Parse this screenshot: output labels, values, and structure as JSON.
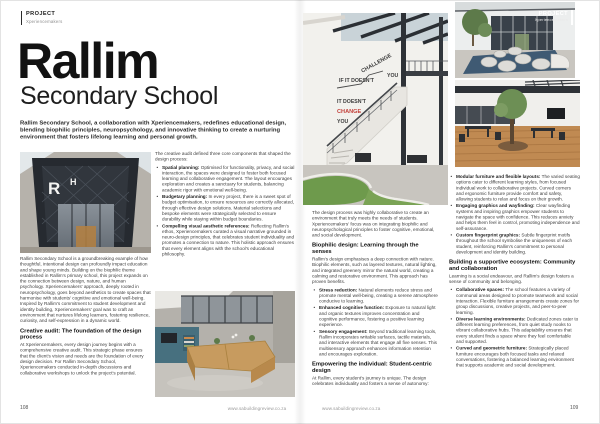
{
  "kicker": {
    "label": "PROJECT",
    "sublabel": "Xperiencemakers"
  },
  "title": {
    "main": "Rallim",
    "sub": "Secondary School"
  },
  "intro": "Rallim Secondary School, a collaboration with Xperiencemakers, redefines educational design, blending biophilic principles, neuropsychology, and innovative thinking to create a nurturing environment that fosters lifelong learning and personal growth.",
  "footer": {
    "url_left": "www.sabuildingreview.co.za",
    "url_right": "www.sabuildingreview.co.za",
    "page_left": "108",
    "page_right": "109"
  },
  "columns": {
    "col1": {
      "para1": "Rallim Secondary School is a groundbreaking example of how thoughtful, intentional design can profoundly impact education and shape young minds. Building on the biophilic theme established in Rallim's primary school, this project expands on the connection between design, nature, and human psychology. Xperiencemakers' approach, deeply rooted in neuropsychology, goes beyond aesthetics to create spaces that harmonise with students' cognitive and emotional well-being. Inspired by Rallim's commitment to student development and identity building, Xperiencemakers' goal was to craft an environment that nurtures lifelong learners, fostering resilience, curiosity, and self-expression in a dynamic world.",
      "heading": "Creative audit: The foundation of the design process",
      "para2": "At Xperiencemakers, every design journey begins with a comprehensive creative audit. This strategic phase ensures that the client's vision and needs are the foundation of every design decision. For Rallim Secondary School, Xperiencemakers conducted in-depth discussions and collaborative workshops to unlock the project's potential."
    },
    "col2": {
      "lead": "The creative audit defined three core components that shaped the design process:",
      "bullets": [
        {
          "term": "Spatial planning:",
          "text": "Optimised for functionality, privacy, and social interaction, the spaces were designed to foster both focused learning and collaborative engagement. The layout encourages exploration and creates a sanctuary for students, balancing academic rigor with emotional well-being."
        },
        {
          "term": "Budgetary planning:",
          "text": "In every project, there is a sweet spot of budget optimisation, to ensure resources are correctly allocated, through effective design solutions. Material selections and bespoke elements were strategically selected to ensure durability while staying within budget boundaries."
        },
        {
          "term": "Compelling visual aesthetic references:",
          "text": "Reflecting Rallim's ethos, Xperiencemakers curated a visual narrative grounded in neuro-design principles, that celebrates student individuality and promotes a connection to nature. This holistic approach ensures that every element aligns with the school's educational philosophy."
        }
      ]
    },
    "col3": {
      "para1": "The design process was highly collaborative to create an environment that truly meets the needs of students. Xperiencemakers' focus was on integrating biophilic and neuropsychological principles to foster cognitive, emotional, and social development.",
      "heading1": "Biophilic design: Learning through the senses",
      "para2": "Rallim's design emphasises a deep connection with nature. Biophilic elements, such as layered textures, natural lighting, and integrated greenery mirror the natural world, creating a calming and restorative environment. This approach has proven benefits.",
      "bullets": [
        {
          "term": "Stress reduction:",
          "text": "Natural elements reduce stress and promote mental well-being, creating a serene atmosphere conducive to learning."
        },
        {
          "term": "Enhanced cognitive function:",
          "text": "Exposure to natural light and organic textures improves concentration and cognitive performance, fostering a positive learning experience."
        },
        {
          "term": "Sensory engagement:",
          "text": "Beyond traditional learning tools, Rallim incorporates writable surfaces, tactile materials, and interactive elements that engage all five senses. This multisensory approach enhances information retention and encourages exploration."
        }
      ],
      "heading2": "Empowering the individual: Student-centric design",
      "para3": "At Rallim, every student's journey is unique. The design celebrates individuality and fosters a sense of autonomy:"
    },
    "col4": {
      "bullets1": [
        {
          "term": "Modular furniture and flexible layouts:",
          "text": "The varied seating options cater to different learning styles, from focused individual work to collaborative projects. Curved corners and ergonomic furniture provide comfort and safety, allowing students to relax and focus on their growth."
        },
        {
          "term": "Engaging graphics and wayfinding:",
          "text": "Clear wayfinding systems and inspiring graphics empower students to navigate the space with confidence. This reduces anxiety and helps them feel in control, promoting independence and self-assurance."
        },
        {
          "term": "Custom fingerprint graphics:",
          "text": "Subtle fingerprint motifs throughout the school symbolise the uniqueness of each student, reinforcing Rallim's commitment to personal development and identity building."
        }
      ],
      "heading": "Building a supportive ecosystem: Community and collaboration",
      "para": "Learning is a social endeavour, and Rallim's design fosters a sense of community and belonging.",
      "bullets2": [
        {
          "term": "Collaborative spaces:",
          "text": "The school features a variety of communal areas designed to promote teamwork and social interaction. Flexible furniture arrangements create zones for group discussions, creative projects, and peer-to-peer learning."
        },
        {
          "term": "Diverse learning environments:",
          "text": "Dedicated zones cater to different learning preferences, from quiet study nooks to vibrant collaborative hubs. This adaptability ensures that every student finds a space where they feel comfortable and supported."
        },
        {
          "term": "Curved and geometric furniture:",
          "text": "Strategically placed furniture encourages both focused tasks and relaxed conversations, fostering a balanced learning environment that supports academic and social development."
        }
      ]
    }
  },
  "photos": {
    "entrance": {
      "logo_r": "R",
      "logo_h": "H"
    },
    "stairs": {
      "wall_line1": "IF IT DOESN'T",
      "wall_challenge": "CHALLENGE",
      "wall_you1": "YOU",
      "wall_line2": "IT DOESN'T",
      "wall_change": "CHANGE",
      "wall_you2": "YOU"
    }
  },
  "colors": {
    "accent_red": "#c2403a",
    "text_dark": "#1c1c1c",
    "text_gray": "#8d8d8d",
    "lawn_green": "#6e9a4c",
    "wood": "#c79b5f",
    "carpet_blue": "#3f5a73"
  }
}
